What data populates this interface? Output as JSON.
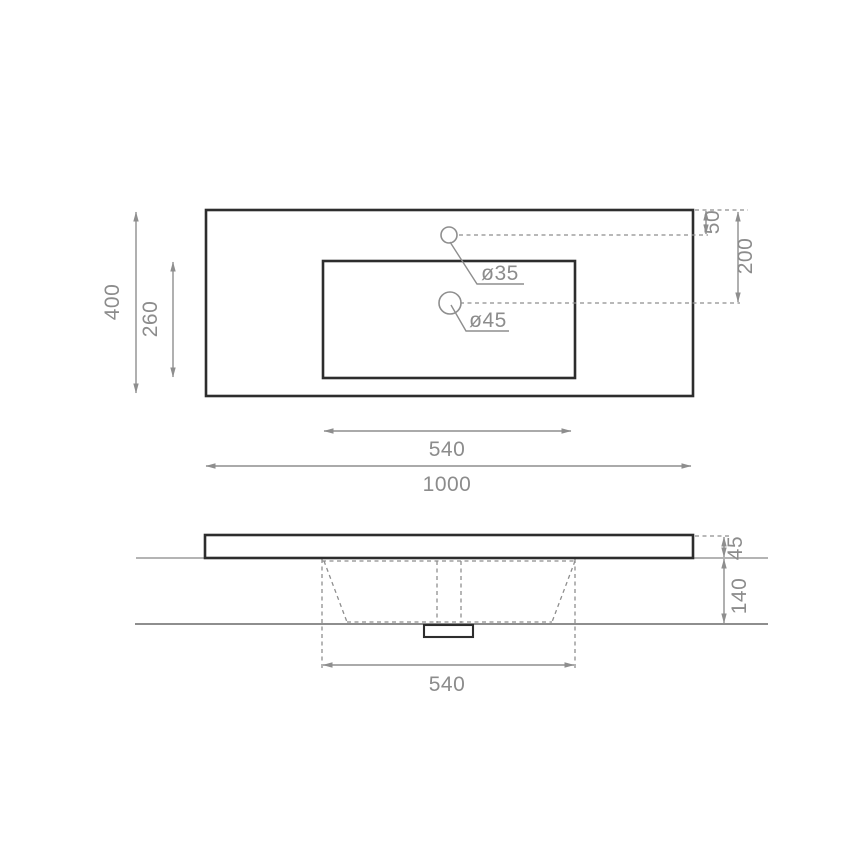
{
  "colors": {
    "outline_dark": "#2d2d2d",
    "dimension_gray": "#8e8e8e",
    "text_gray": "#8c8c8c",
    "wall_gray": "#9b9b9b",
    "background": "#ffffff"
  },
  "top_view": {
    "overall_width": "1000",
    "overall_depth": "400",
    "cutout_width": "540",
    "cutout_depth": "260",
    "faucet_hole_from_top": "50",
    "drain_hole_from_top": "200",
    "faucet_hole_diameter": "ø35",
    "drain_hole_diameter": "ø45"
  },
  "side_view": {
    "top_thickness": "45",
    "basin_depth": "140",
    "basin_width": "540"
  }
}
